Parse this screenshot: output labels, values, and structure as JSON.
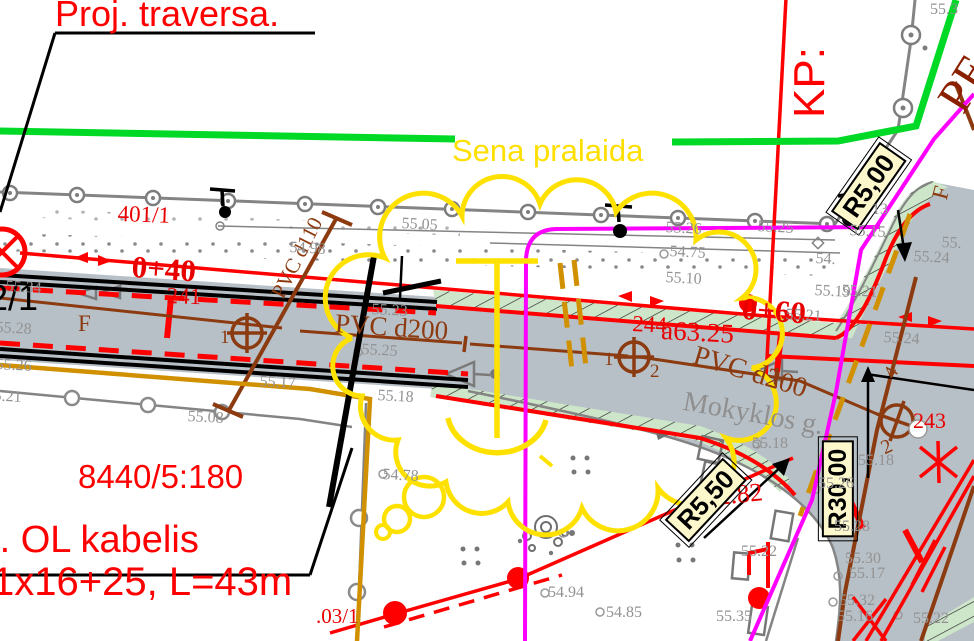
{
  "plan": {
    "callouts": {
      "proj_traversa": "Proj. traversa.",
      "cable_line1": "Proj. OL kabelis",
      "cable_line2": "1x16+25, L=43m",
      "parcel_number": "8440/5:180",
      "old_culvert": "Sena pralaida",
      "kp": "KP:",
      "pe": "PE",
      "street_name": "Mokyklos g.",
      "block_number": "2/1"
    },
    "radius_labels": {
      "r1": "R5,00",
      "r2": "R30,00",
      "r3": "R5,50"
    },
    "stations": {
      "s1": "0+40",
      "s2": "0+60"
    },
    "poles": {
      "p1": "401/1",
      "p2": "241",
      "p3": "244",
      "p4": "243",
      "p5": ".03/1"
    },
    "dimensions": {
      "a": "a63.25",
      "b": "2.82"
    },
    "pipes": {
      "d110": "PVC d110",
      "d200_left": "PVC d200",
      "d200_right": "PVC d200",
      "f_main": "F",
      "f_side": "F"
    },
    "valve_marks": {
      "m1": "1",
      "m2": "1",
      "m3": "2",
      "m4": "4",
      "m5": "2"
    },
    "elevations": [
      {
        "t": "55.34",
        "x": 6,
        "y": 279,
        "rot": 3
      },
      {
        "t": "55.28",
        "x": -4,
        "y": 320,
        "rot": 3
      },
      {
        "t": "55.26",
        "x": -4,
        "y": 357,
        "rot": 3
      },
      {
        "t": "55.21",
        "x": -14,
        "y": 388,
        "rot": 3
      },
      {
        "t": "55.17",
        "x": 260,
        "y": 374,
        "rot": 3
      },
      {
        "t": "55.08",
        "x": 188,
        "y": 409,
        "rot": 3
      },
      {
        "t": "54.98",
        "x": 290,
        "y": 240,
        "rot": 3
      },
      {
        "t": "55.05",
        "x": 402,
        "y": 216,
        "rot": 3
      },
      {
        "t": "55.23",
        "x": 372,
        "y": 302,
        "rot": 3
      },
      {
        "t": "55.25",
        "x": 362,
        "y": 342,
        "rot": 3
      },
      {
        "t": "55.18",
        "x": 378,
        "y": 388,
        "rot": 3
      },
      {
        "t": "54.78",
        "x": 383,
        "y": 467,
        "rot": 3
      },
      {
        "t": "55.26",
        "x": 666,
        "y": 220,
        "rot": 3
      },
      {
        "t": "54.75",
        "x": 670,
        "y": 244,
        "rot": 3
      },
      {
        "t": "55.10",
        "x": 666,
        "y": 270,
        "rot": 3
      },
      {
        "t": "55.25",
        "x": 758,
        "y": 219,
        "rot": 3
      },
      {
        "t": "13",
        "x": 872,
        "y": 202,
        "rot": 0
      },
      {
        "t": "55.15",
        "x": 850,
        "y": 223,
        "rot": 3
      },
      {
        "t": "54.",
        "x": 816,
        "y": 251,
        "rot": 3
      },
      {
        "t": "55.",
        "x": 942,
        "y": 235,
        "rot": 3
      },
      {
        "t": "55.24",
        "x": 914,
        "y": 249,
        "rot": 3
      },
      {
        "t": "55.19",
        "x": 815,
        "y": 283,
        "rot": 3
      },
      {
        "t": "55.21",
        "x": 842,
        "y": 283,
        "rot": 3
      },
      {
        "t": "55.21",
        "x": 786,
        "y": 307,
        "rot": 3
      },
      {
        "t": "55.24",
        "x": 884,
        "y": 330,
        "rot": 3
      },
      {
        "t": "55.18",
        "x": 752,
        "y": 436,
        "rot": 0
      },
      {
        "t": "55.18",
        "x": 858,
        "y": 453,
        "rot": 0
      },
      {
        "t": "55.26",
        "x": 818,
        "y": 476,
        "rot": 0
      },
      {
        "t": "55.28",
        "x": 834,
        "y": 519,
        "rot": 0
      },
      {
        "t": "55.30",
        "x": 845,
        "y": 551,
        "rot": 0
      },
      {
        "t": "55.17",
        "x": 849,
        "y": 566,
        "rot": 0
      },
      {
        "t": "55.32",
        "x": 839,
        "y": 593,
        "rot": 0
      },
      {
        "t": "55.16",
        "x": 837,
        "y": 609,
        "rot": 0
      },
      {
        "t": "55.22",
        "x": 913,
        "y": 611,
        "rot": 0
      },
      {
        "t": "55.35",
        "x": 716,
        "y": 609,
        "rot": 0
      },
      {
        "t": "55.22",
        "x": 741,
        "y": 544,
        "rot": 0
      },
      {
        "t": "54.94",
        "x": 548,
        "y": 585,
        "rot": 0
      },
      {
        "t": "54.85",
        "x": 606,
        "y": 605,
        "rot": 0
      },
      {
        "t": "55.3",
        "x": 930,
        "y": 2,
        "rot": 0
      }
    ]
  },
  "colors": {
    "road_fill": "#b8c0c7",
    "green_strip": "#cde5c9",
    "bright_green": "#00d926",
    "magenta": "#ff00ff",
    "ochre": "#d09000",
    "brown": "#8c3a10",
    "red": "#ff0000",
    "yellow_cloud": "#ffe100",
    "label_bg": "#fcf8cc",
    "gray_line": "#848484"
  }
}
